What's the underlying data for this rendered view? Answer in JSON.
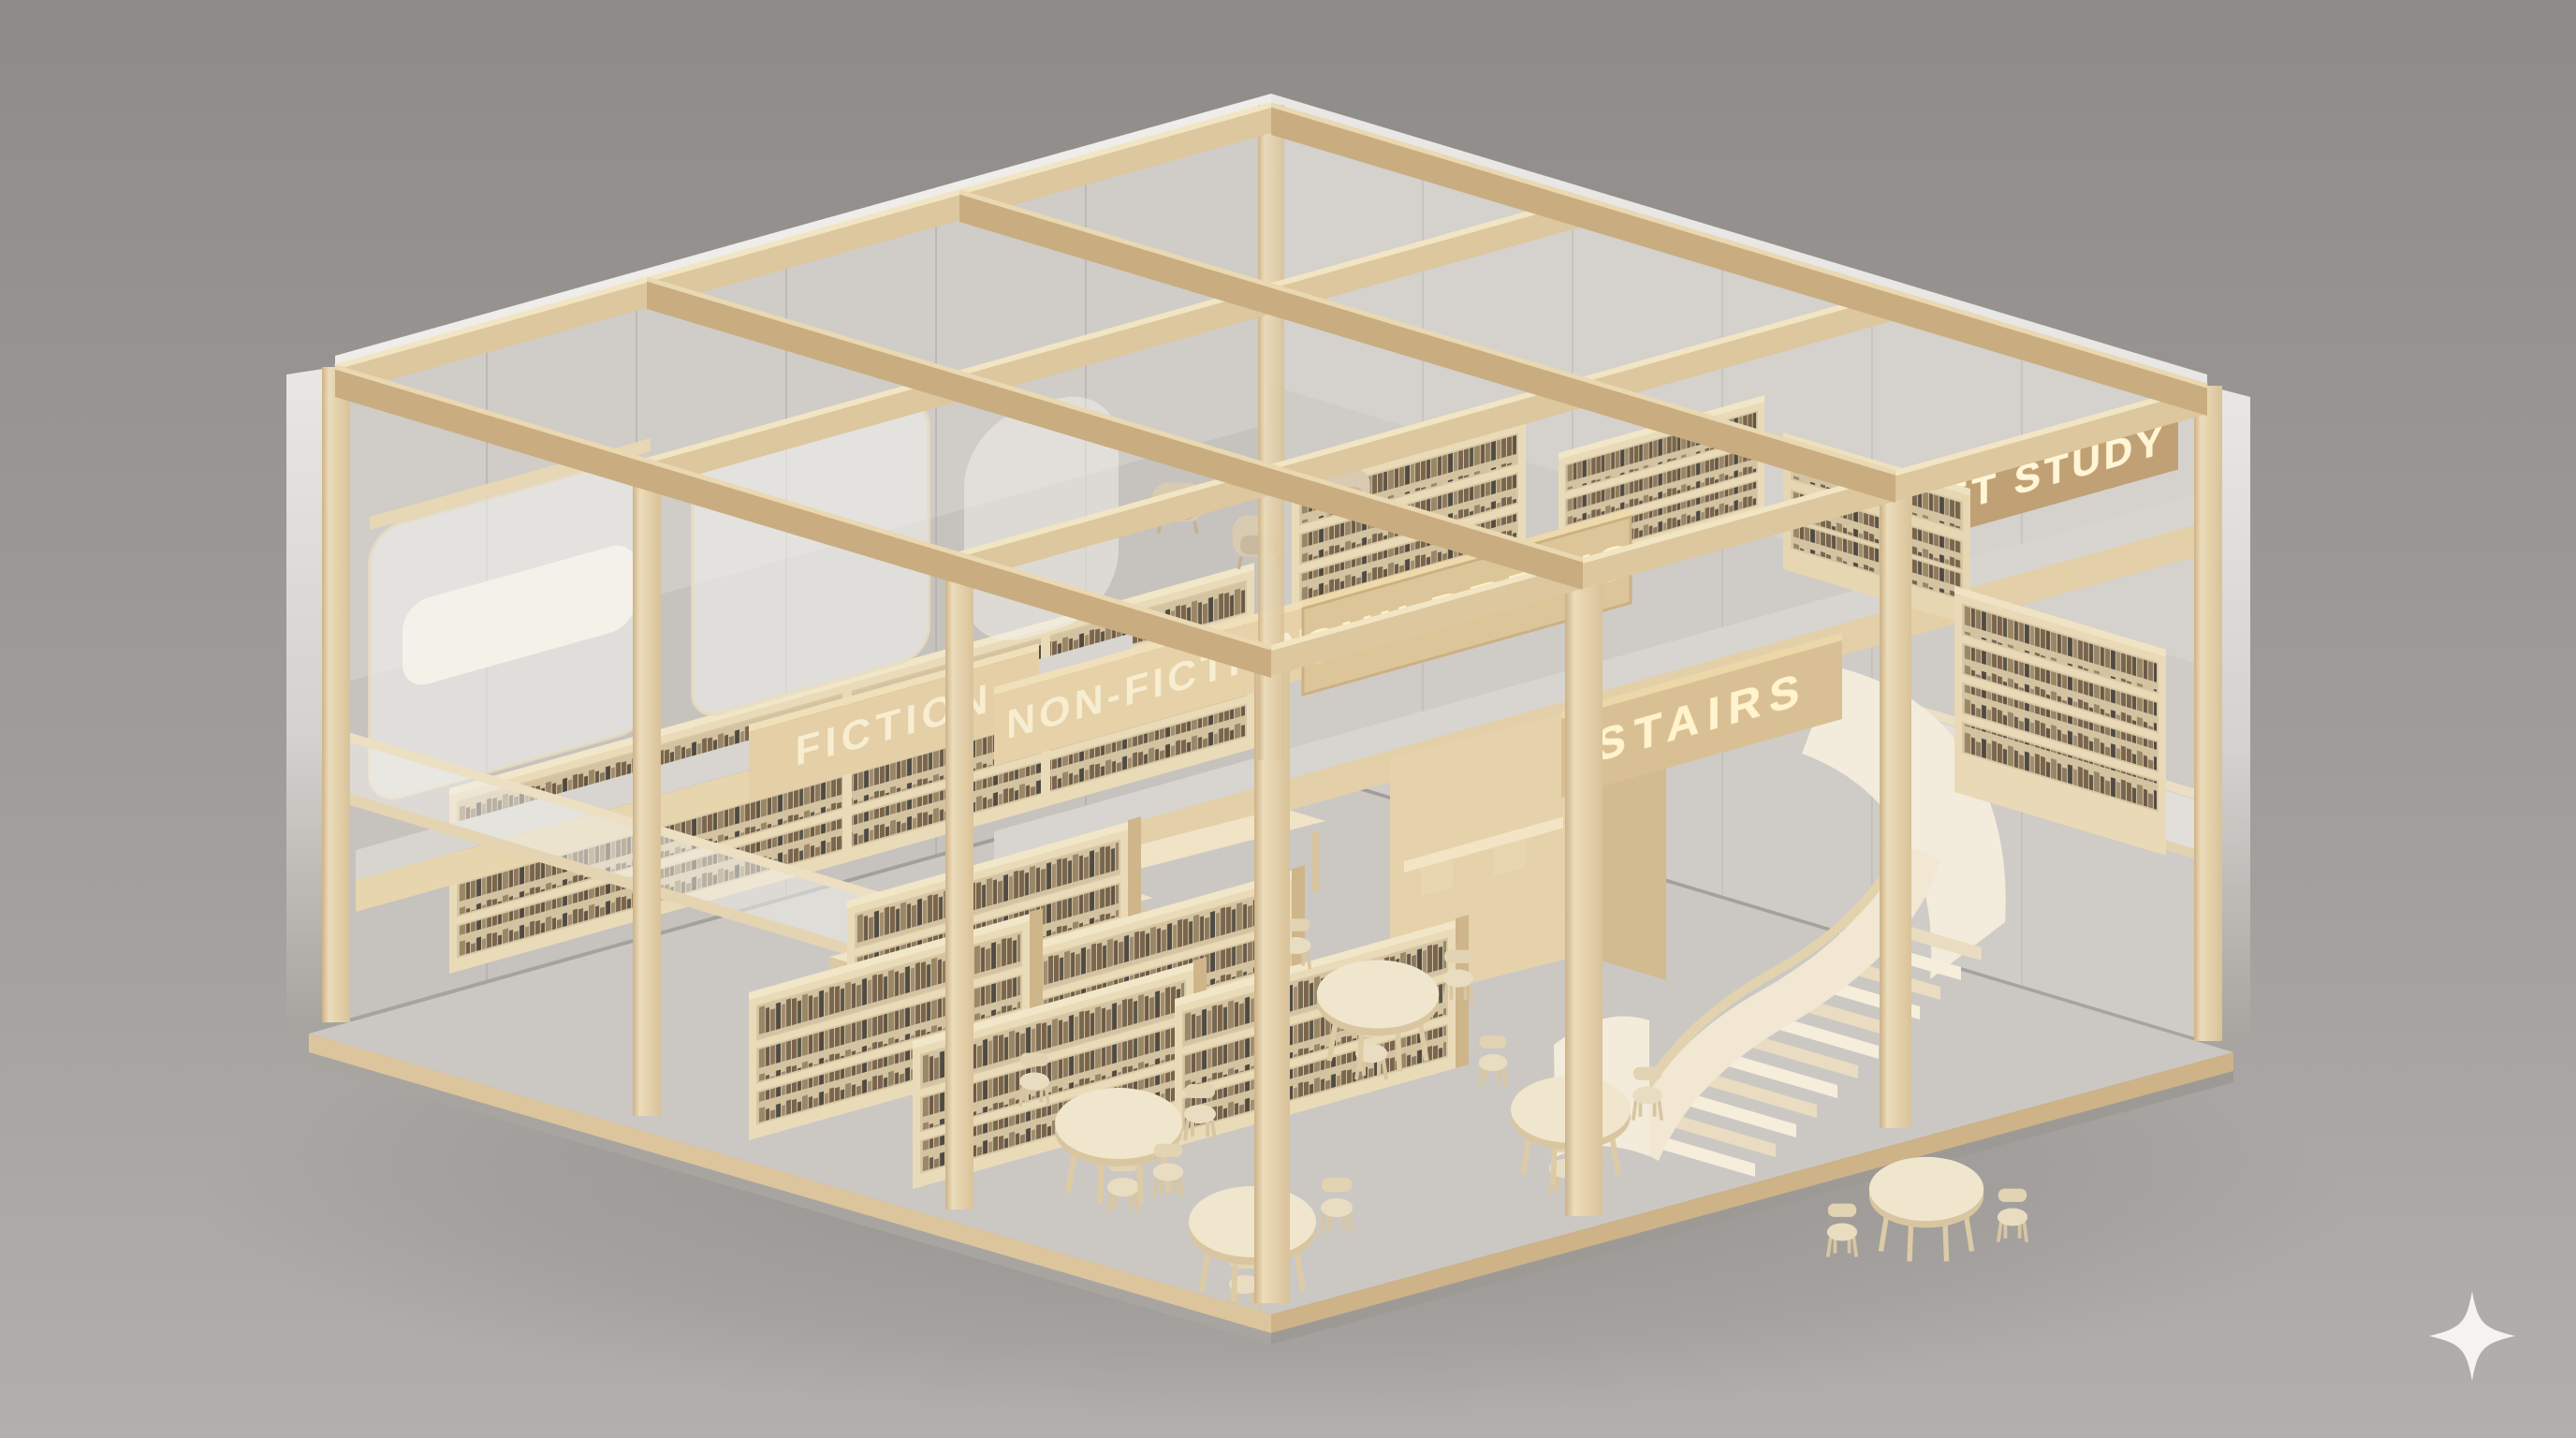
{
  "scene": {
    "description": "Isometric miniature model of a two-storey timber library on a seamless gray studio backdrop",
    "style": "photorealistic 3D render, light plywood post-and-beam structure, open roof grid",
    "floors": {
      "ground": "reading hall with wall shelving, freestanding book stacks, long study tables, round tables with chairs, curved stair",
      "mezzanine": "frosted-glass study rooms, children's shelving with lounge chairs, quiet study lounge behind frosted balustrade"
    }
  },
  "signs": {
    "fiction": "FICTION",
    "non_fiction": "NON-FICTION",
    "childrens": "CHILDREN'S",
    "stairs": "STAIRS",
    "quiet_study": "QUIET STUDY"
  },
  "furniture": {
    "round_tables": 5,
    "chairs_per_round_table": "3-4",
    "long_tables": 2,
    "freestanding_book_stacks": 5,
    "wall_shelf_bays": 4,
    "upstairs_shelf_units": 3,
    "lounge_armchairs_upstairs": 5,
    "staircase": "curved / spiral stair rising left-to-right"
  },
  "watermark": {
    "icon": "sparkle-icon",
    "color": "#f4f3f1"
  },
  "palette": {
    "background_top": "#8e8b88",
    "background_bottom": "#b2afac",
    "wood_light": "#eedfbd",
    "wood_mid": "#dcc49c",
    "wood_dark": "#c2a57c",
    "floor_gray": "#cbc8c4",
    "wall_felt": "#c6c2bd",
    "frosted_glass": "#f0eeea",
    "stair_cream": "#f3ebd9",
    "sign_letter_glow": "#fff3d0",
    "book_spines": [
      "#7a644c",
      "#5a5547",
      "#998767",
      "#6b5a48",
      "#8d7a5e",
      "#4f4b43",
      "#a28e6f",
      "#776650"
    ]
  }
}
